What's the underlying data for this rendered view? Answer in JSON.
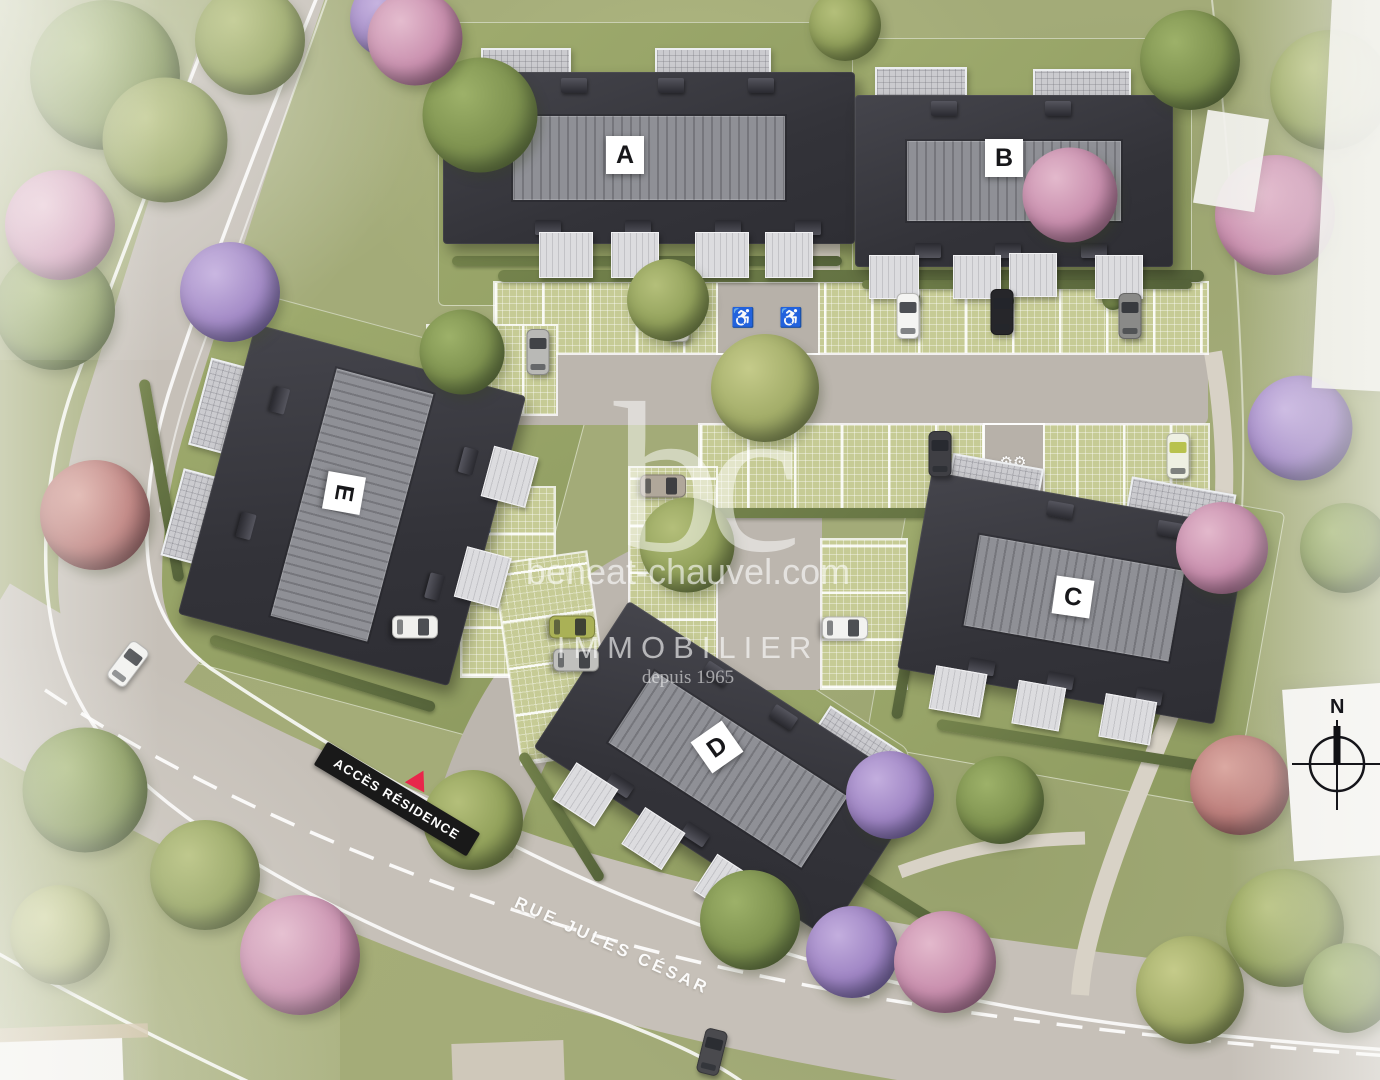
{
  "title": "Plan de masse aérien de la résidence",
  "buildings": [
    {
      "label": "A"
    },
    {
      "label": "B"
    },
    {
      "label": "C"
    },
    {
      "label": "D"
    },
    {
      "label": "E"
    }
  ],
  "watermark": {
    "logo_text": "bc",
    "website": "beneat-chauvel.com",
    "brand": "IMMOBILIER",
    "tagline": "depuis 1965"
  },
  "street": {
    "name": "RUE JULES CÉSAR"
  },
  "access_sign": {
    "label": "ACCÈS RÉSIDENCE"
  },
  "compass": {
    "north_label": "N"
  },
  "markings": {
    "handicap_symbol": "♿"
  },
  "palette": {
    "roof_dark": "#38383e",
    "roof_ridge": "#8f9096",
    "grass": "#a3ab78",
    "road": "#c6c0b8",
    "paver": "#c6cb95",
    "sign_black": "#191919",
    "sign_red": "#e8274b"
  }
}
